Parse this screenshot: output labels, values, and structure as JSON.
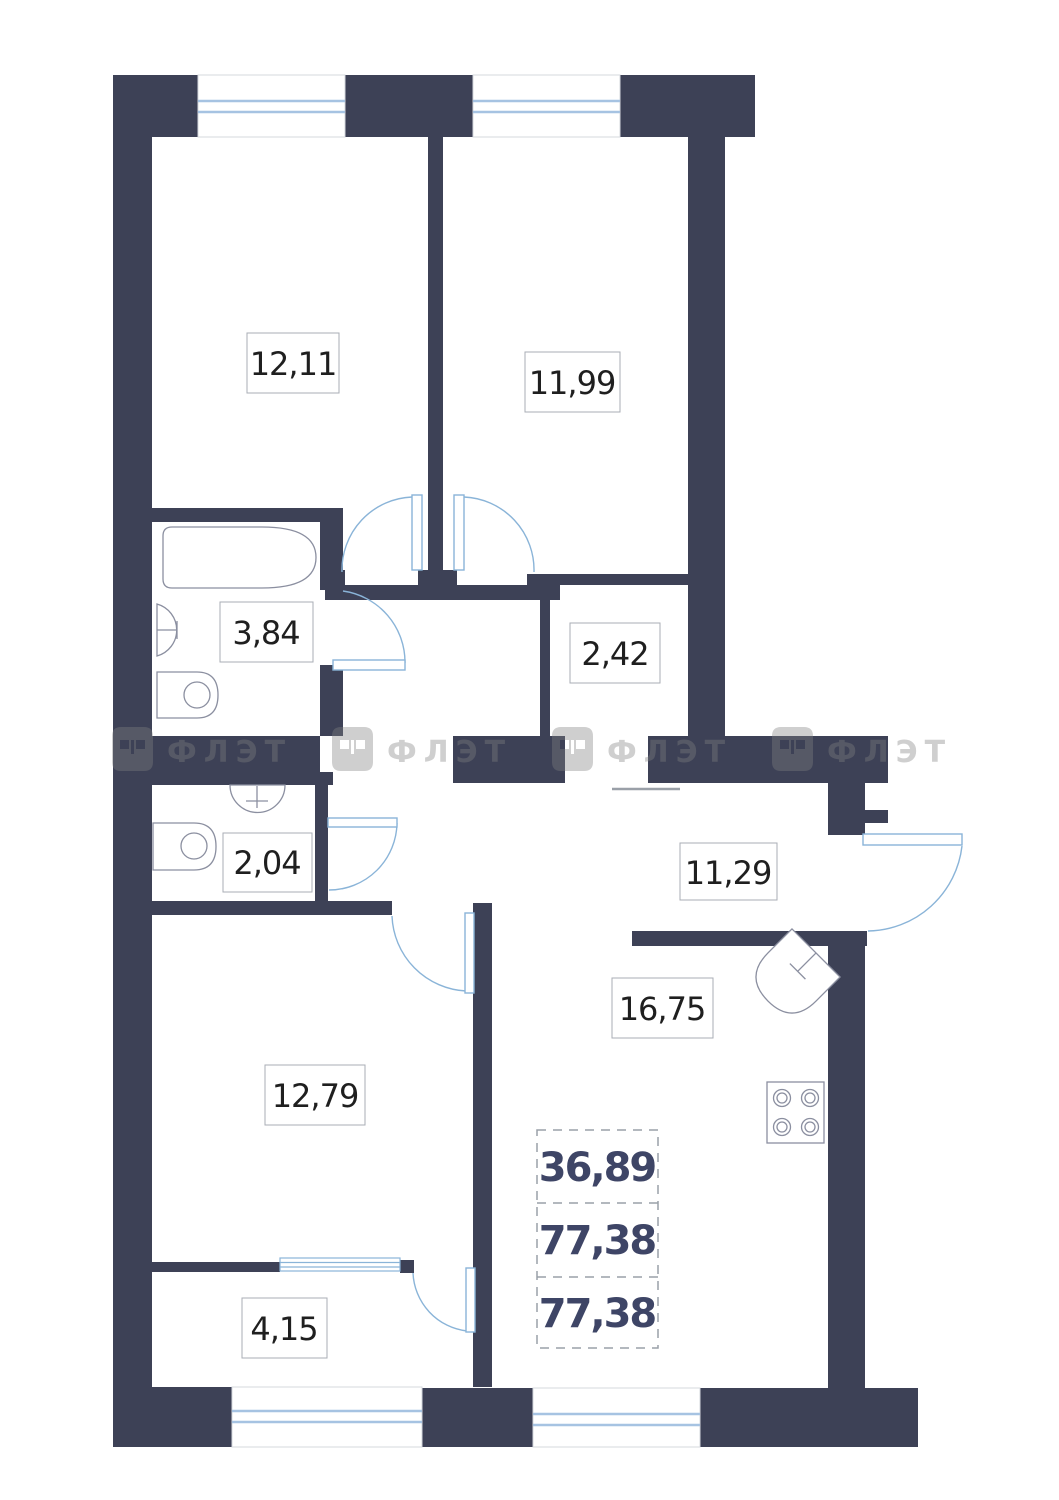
{
  "watermark": {
    "text": "ФЛЭТ"
  },
  "rooms": [
    {
      "id": "room-1",
      "area": "12,11"
    },
    {
      "id": "room-2",
      "area": "11,99"
    },
    {
      "id": "bathroom",
      "area": "3,84"
    },
    {
      "id": "niche",
      "area": "2,42"
    },
    {
      "id": "wc",
      "area": "2,04"
    },
    {
      "id": "hallway",
      "area": "11,29"
    },
    {
      "id": "kitchen-living",
      "area": "16,75"
    },
    {
      "id": "room-3",
      "area": "12,79"
    },
    {
      "id": "wardrobe",
      "area": "4,15"
    }
  ],
  "summary": {
    "living_area": "36,89",
    "total_area": "77,38",
    "reduced_total_area": "77,38"
  },
  "colors": {
    "wall": "#3d4156",
    "window_line": "#a6c3e2",
    "door_line": "#8ab4d8",
    "fixture_line": "#8b8fa0",
    "label_text": "#1f1f1f",
    "summary_text": "#3e4566"
  }
}
